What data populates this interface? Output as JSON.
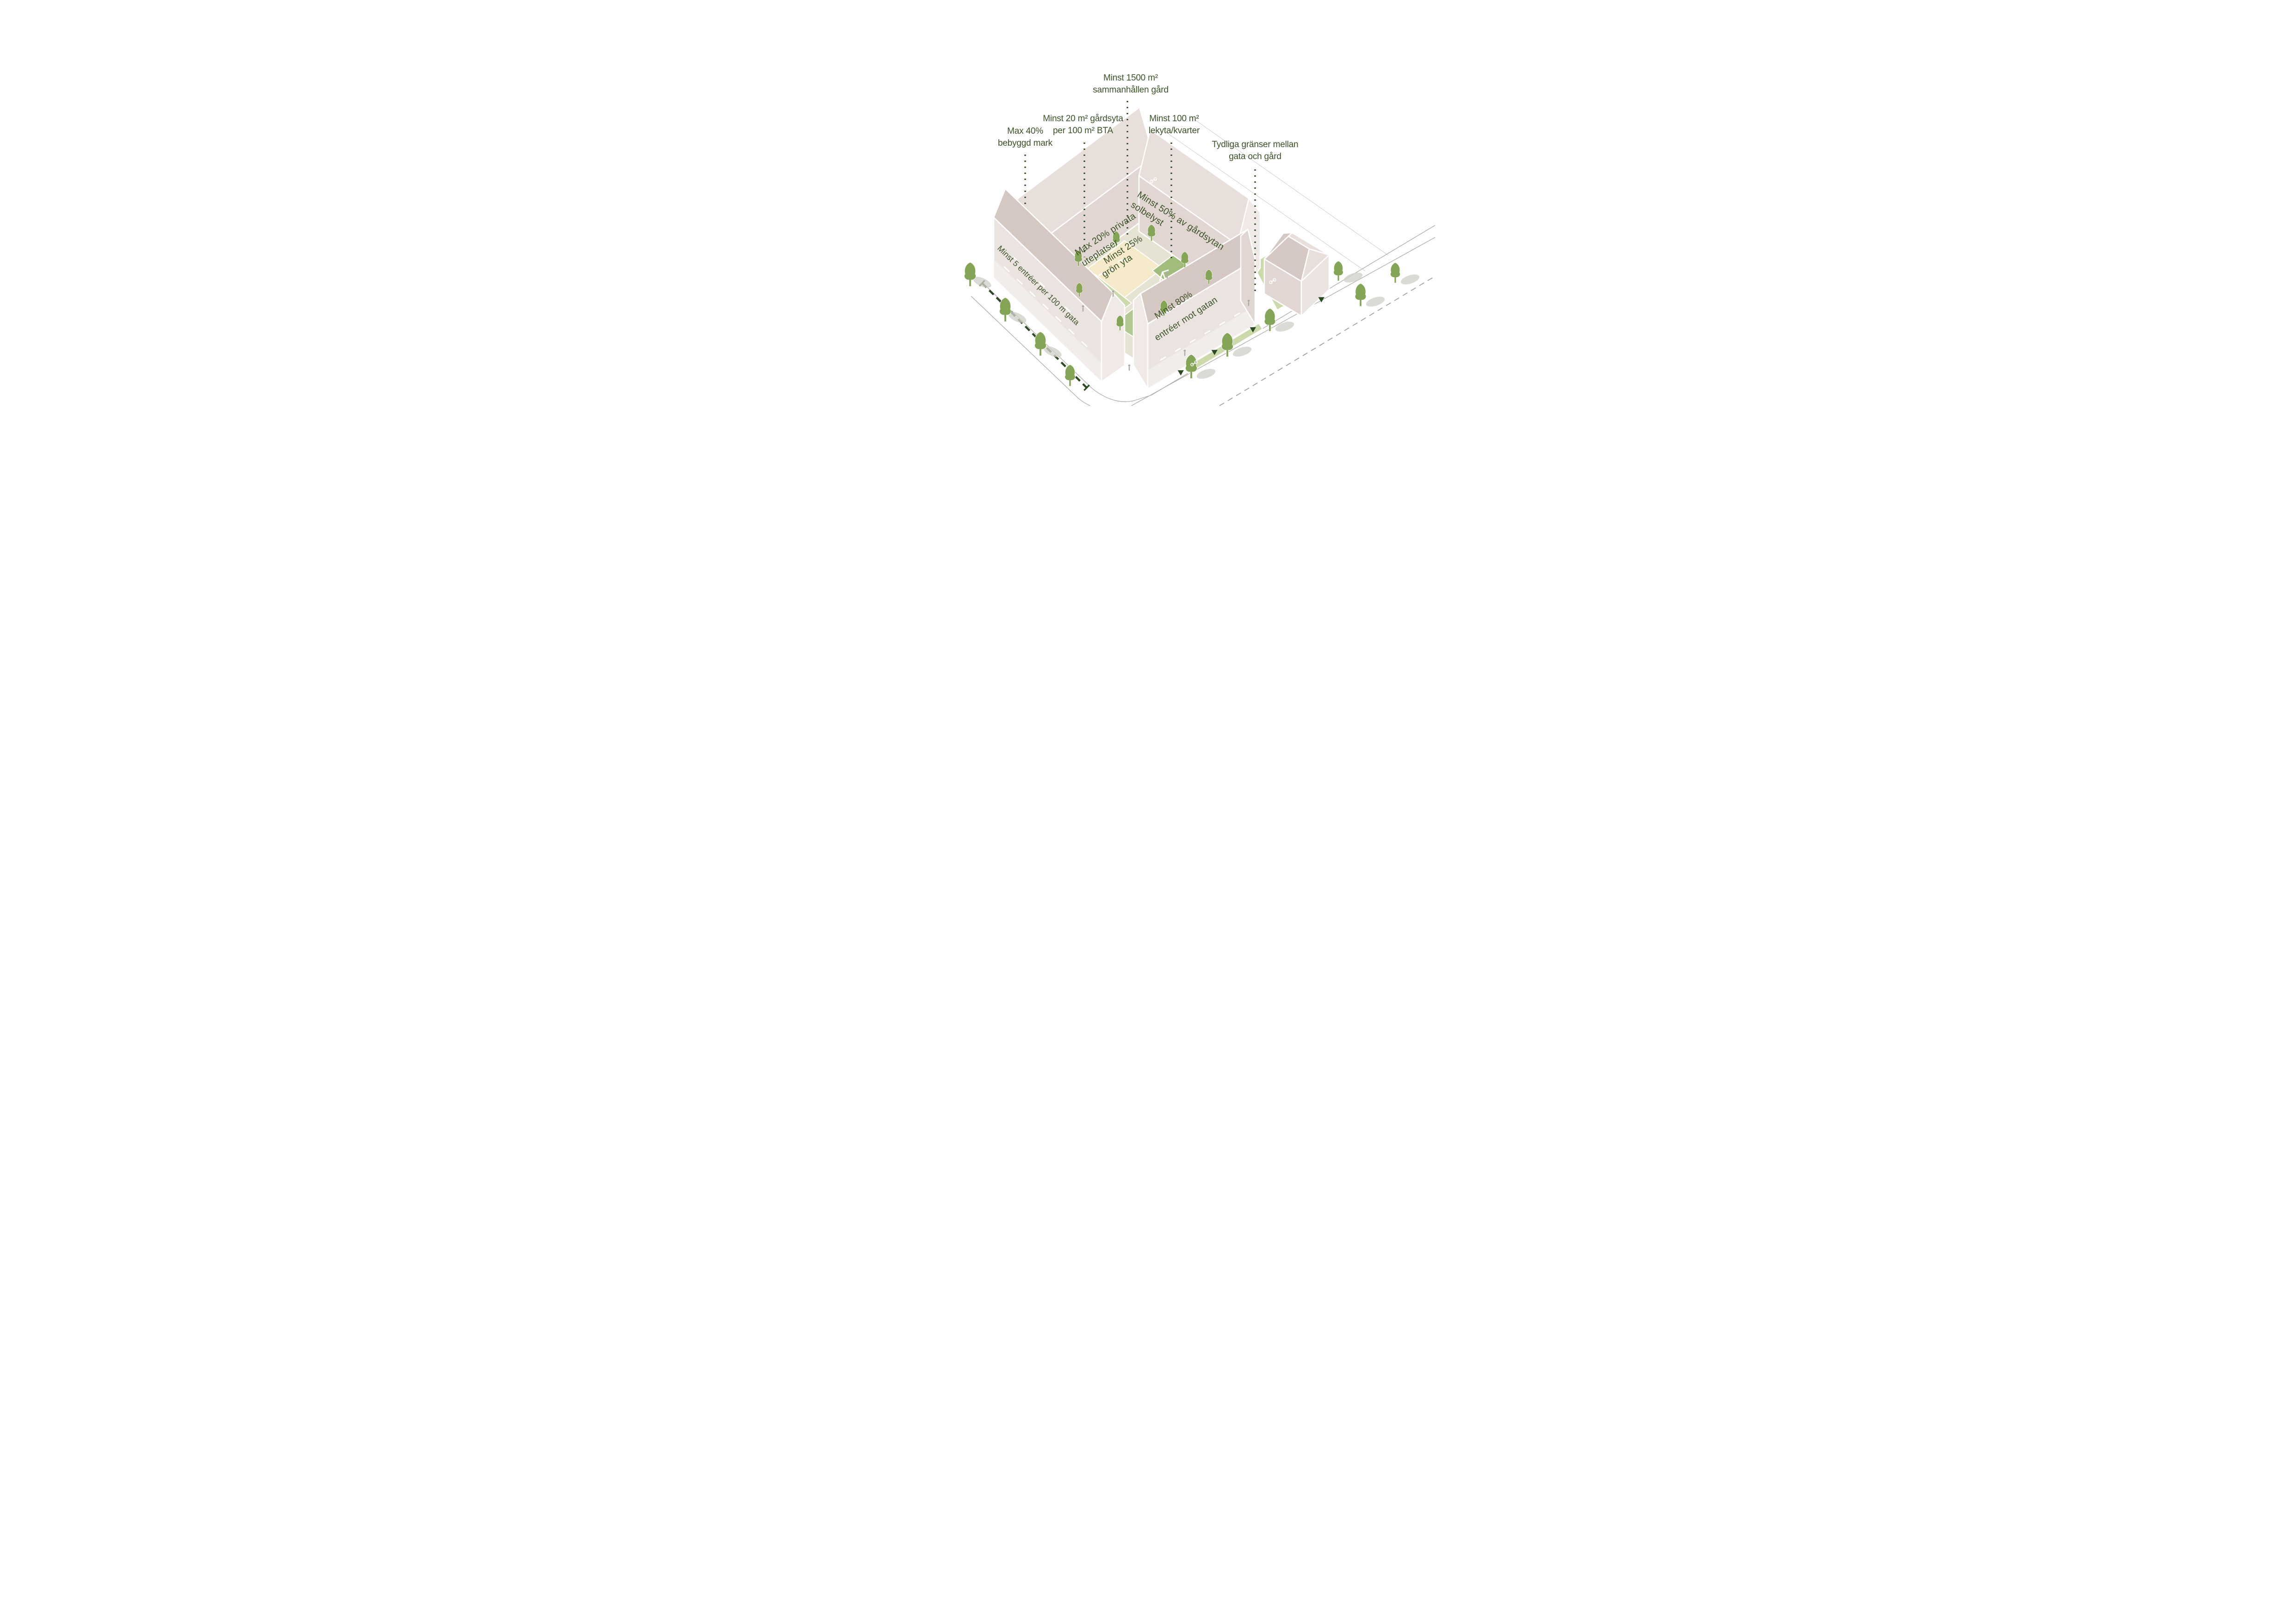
{
  "annotations": {
    "cohesive_yard": {
      "line1": "Minst 1500 m²",
      "line2": "sammanhållen gård"
    },
    "yard_per_bta": {
      "line1": "Minst 20 m² gårdsyta",
      "line2": "per 100 m² BTA"
    },
    "max_built": {
      "line1": "Max 40%",
      "line2": "bebyggd mark"
    },
    "play_area": {
      "line1": "Minst 100 m²",
      "line2": "lekyta/kvarter"
    },
    "clear_boundaries": {
      "line1": "Tydliga gränser mellan",
      "line2": "gata och gård"
    }
  },
  "courtyard_texts": {
    "sunlit": {
      "line1": "Minst 50% av gårdsytan",
      "line2": "solbelyst"
    },
    "private_patios": {
      "line1": "Max 20% privata",
      "line2": "uteplatser"
    },
    "green_area": {
      "line1": "Minst 25%",
      "line2": "grön yta"
    }
  },
  "facade_texts": {
    "entrances_per_100m": {
      "text": "Minst 5 entréer per 100 m gata"
    },
    "entrances_to_street": {
      "line1": "Minst 80%",
      "line2": "entréer mot gatan"
    }
  },
  "colors": {
    "text_green": "#3c5227",
    "leader_green": "#35512a",
    "measure_green": "#2c4a22",
    "arrow_green": "#2c4a22",
    "wall_light": "#ebe3e0",
    "wall_mid": "#e1d6d2",
    "wall_dark": "#d9ccc7",
    "roof_light": "#e8dfdb",
    "roof_dark": "#d5c7c1",
    "gable": "#f0e9e6",
    "courtyard_path": "#e6e3d3",
    "plaza": "#f5eaca",
    "lawn_light": "#cbd9ab",
    "lawn_mid": "#b2c992",
    "lawn_dark": "#a0bd7c",
    "hedge": "#a2bd7d",
    "pond": "#dce3d6",
    "tree": "#84a556",
    "shadow": "#d2cfc9",
    "street_line": "#b3b0ab",
    "dash_line": "#a09d98"
  }
}
